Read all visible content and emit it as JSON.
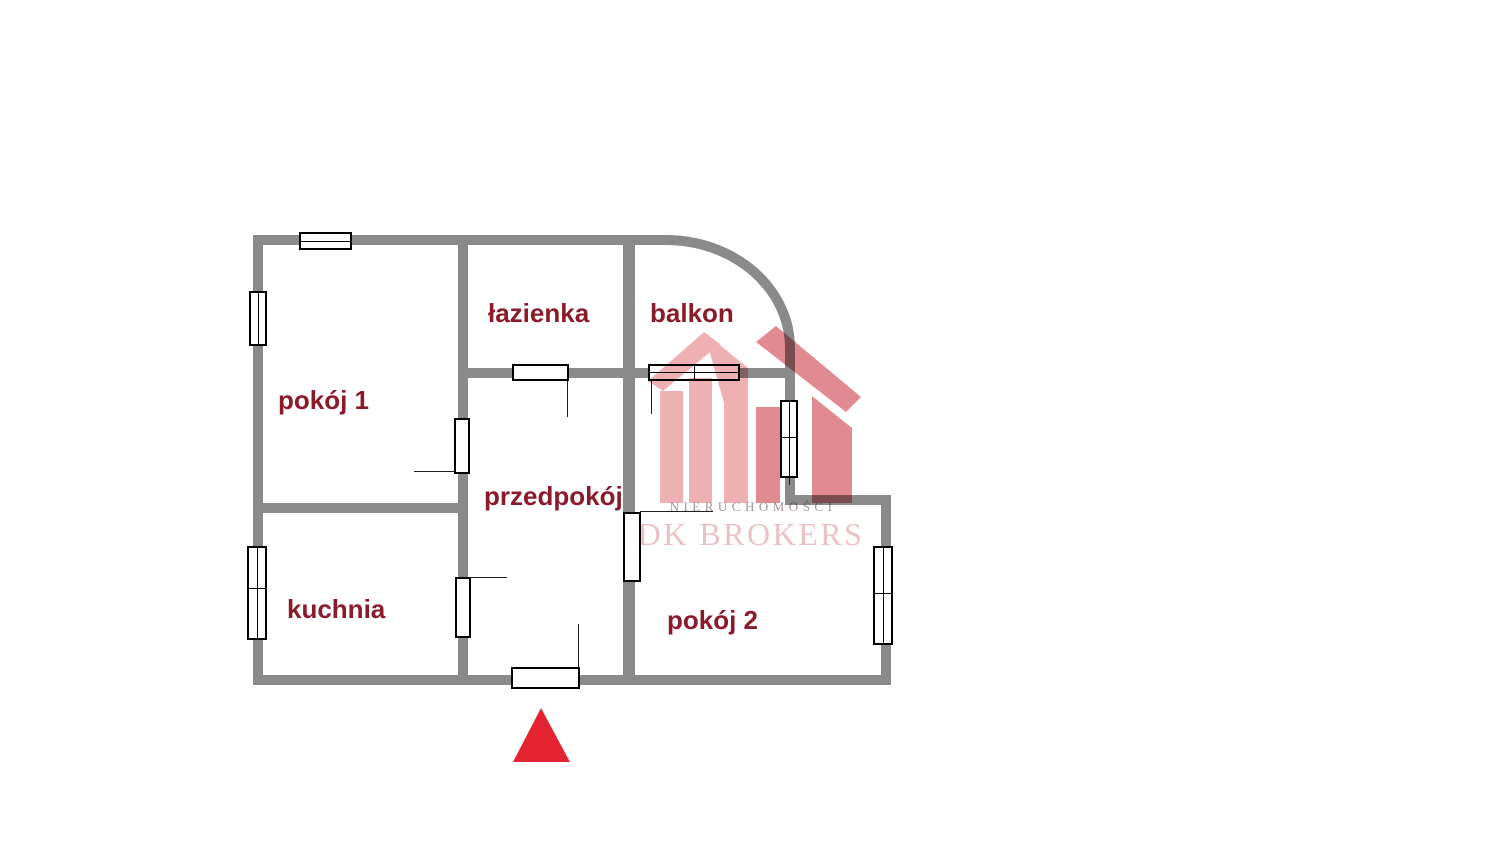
{
  "floorplan": {
    "rooms": [
      {
        "id": "pokoj-1",
        "label": "pokój 1"
      },
      {
        "id": "lazienka",
        "label": "łazienka"
      },
      {
        "id": "balkon",
        "label": "balkon"
      },
      {
        "id": "przedpokoj",
        "label": "przedpokój"
      },
      {
        "id": "kuchnia",
        "label": "kuchnia"
      },
      {
        "id": "pokoj-2",
        "label": "pokój 2"
      }
    ],
    "icons": {
      "entrance_marker": "up-triangle",
      "logo": "dk-brokers-house-logo",
      "windows": "window-box",
      "doors": "door-box"
    }
  },
  "watermark": {
    "subtitle": "NIERUCHOMOŚCI",
    "brand": "DK BROKERS"
  },
  "colors": {
    "wall": "#8a8a8a",
    "room_label": "#8b1b2b",
    "entrance_marker": "#e32430",
    "logo_light": "#efb0b4",
    "logo_dark": "#e28a91",
    "logo_brand_text": "#eac2c5",
    "logo_subtitle_text": "#a29596"
  }
}
